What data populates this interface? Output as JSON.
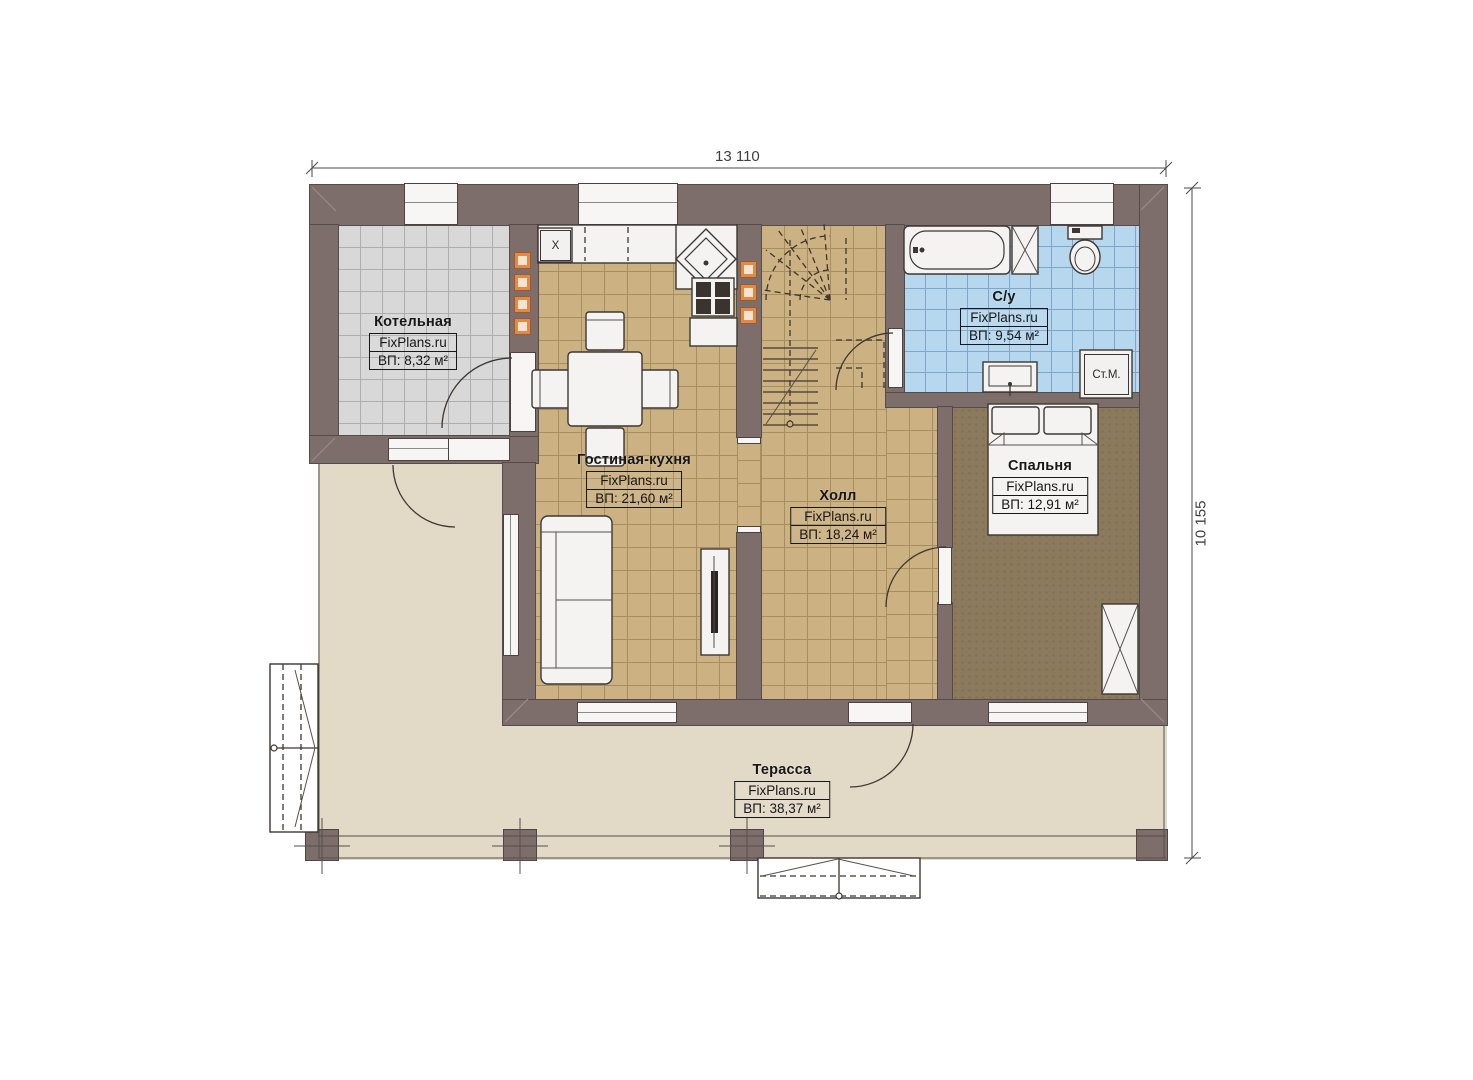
{
  "plan_title": "План 1-го этажа",
  "dimensions": {
    "width_label": "13 110",
    "height_label": "10 155"
  },
  "watermark": "FixPlans.ru",
  "rooms": [
    {
      "id": "boiler",
      "name": "Котельная",
      "brand": "FixPlans.ru",
      "area": "ВП: 8,32 м²"
    },
    {
      "id": "living",
      "name": "Гостиная-кухня",
      "brand": "FixPlans.ru",
      "area": "ВП: 21,60 м²"
    },
    {
      "id": "hall",
      "name": "Холл",
      "brand": "FixPlans.ru",
      "area": "ВП: 18,24 м²"
    },
    {
      "id": "bath",
      "name": "С/у",
      "brand": "FixPlans.ru",
      "area": "ВП: 9,54 м²"
    },
    {
      "id": "bedroom",
      "name": "Спальня",
      "brand": "FixPlans.ru",
      "area": "ВП: 12,91 м²"
    },
    {
      "id": "terrace",
      "name": "Терасса",
      "brand": "FixPlans.ru",
      "area": "ВП: 38,37 м²"
    }
  ],
  "appliances": {
    "washing_machine": "Ст.М.",
    "kitchen_cell": "X"
  },
  "colors": {
    "wall": "#7d6d6b",
    "boiler_floor": "#d8d8d8",
    "wood_floor": "#ccb183",
    "bath_floor": "#b7d7ee",
    "bedroom_floor": "#8b7a5c",
    "terrace_floor": "#e3d9c7",
    "vent_orange": "#e08a4a",
    "fixture_white": "#f4f3f1"
  }
}
